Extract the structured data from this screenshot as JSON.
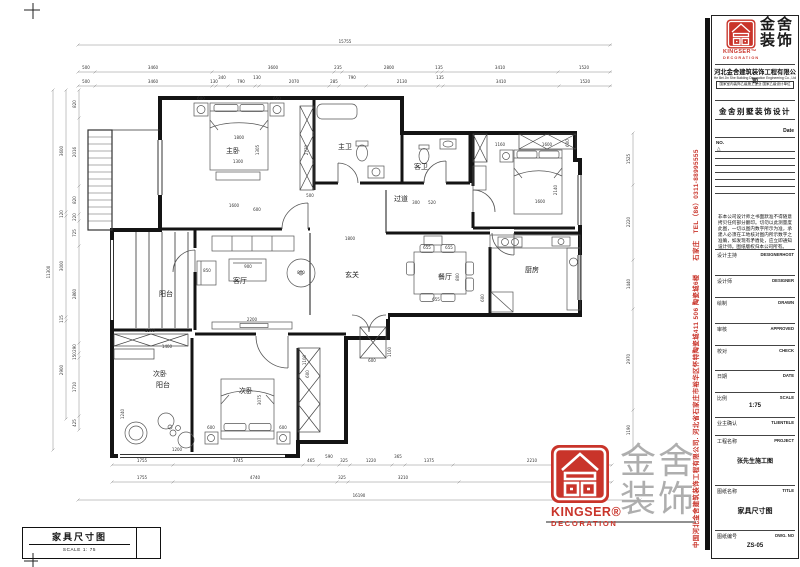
{
  "titleblock": {
    "logo": {
      "en": "KINGSER™",
      "en_sub": "DECORATION",
      "cn_line1": "金舍",
      "cn_line2": "装饰"
    },
    "company_cn": "河北金舍建筑装饰工程有限公司",
    "company_en": "He Bei Jin She Building Decoration Engineering Co., Ltd",
    "credential": "国家室内装饰乙级施工企业 国家乙级设计单位",
    "project_heading": "金舍别墅装饰设计",
    "date_label": "Date",
    "no_label": "NO.",
    "revision_mark": "△",
    "disclaimer": "非本公司设计师之书面默准不得随意拷贝任何部分翻印。切勿以此测量度此图，一切以图内数字所示为准，承建人必须在工地核对图内所示数字之准确，如发现有矛盾处，应立即通知设计师。图纸版权归本公司所有。",
    "fields": [
      {
        "cn": "设计主持",
        "en": "DESIGNERHOST",
        "value": ""
      },
      {
        "cn": "设计师",
        "en": "DESIGNER",
        "value": ""
      },
      {
        "cn": "绘制",
        "en": "DRAWN",
        "value": ""
      },
      {
        "cn": "审核",
        "en": "APPROVED",
        "value": ""
      },
      {
        "cn": "校对",
        "en": "CHECK",
        "value": ""
      },
      {
        "cn": "日期",
        "en": "DATE",
        "value": ""
      },
      {
        "cn": "比例",
        "en": "SCALE",
        "value": "1:75"
      },
      {
        "cn": "业主确认",
        "en": "TLIENTELE",
        "value": ""
      },
      {
        "cn": "工程名称",
        "en": "PROJECT",
        "value": "张先生施工图"
      },
      {
        "cn": "图纸名称",
        "en": "TITLE",
        "value": "家具尺寸图"
      },
      {
        "cn": "图纸编号",
        "en": "DWG. NO",
        "value": "ZS-05"
      }
    ]
  },
  "side_text": "中国河北金舍建筑装饰工程有限公司. 河北省石家庄市裕华区怀特陶瓷城411 506 陶瓷城6楼　　石家庄　TEL（86）0311-88995555",
  "footer": {
    "title": "家具尺寸图",
    "scale": "SCALE 1: 75"
  },
  "watermark": {
    "en": "KINGSER®",
    "en_sub": "DECORATION",
    "cn_line1": "金舍",
    "cn_line2": "装饰"
  },
  "colors": {
    "accent_red": "#c9342a",
    "line_black": "#141414",
    "dim_gray": "#555555"
  },
  "plan": {
    "rooms": {
      "master": "主卧",
      "mbath": "主卫",
      "gbath": "客卫",
      "hall": "过道",
      "foyer": "玄关",
      "living": "客厅",
      "dining": "餐厅",
      "kitchen": "厨房",
      "balcony": "阳台",
      "bal2a": "次卧",
      "bal2b": "阳台",
      "bed2": "次卧"
    },
    "dims": {
      "topall": "15755",
      "top1": [
        "500",
        "3460",
        "3600",
        "235",
        "2800",
        "135",
        "3410",
        "1520"
      ],
      "top2": [
        "500",
        "3460",
        "130",
        "340",
        "790",
        "130",
        "2070",
        "285",
        "790",
        "2130",
        "135",
        "3410",
        "1520"
      ],
      "leftall": "11300",
      "left1": [
        "3600",
        "120",
        "3000",
        "115",
        "2900"
      ],
      "left2": [
        "820",
        "2016",
        "820",
        "220",
        "725",
        "2860",
        "290",
        "150",
        "1710",
        "425"
      ],
      "right1": [
        "1525",
        "2220",
        "1440",
        "2970",
        "1190"
      ],
      "bottomall": "16190",
      "bottom1": [
        "1755",
        "3745",
        "465",
        "590",
        "325",
        "1220",
        "365",
        "1375",
        "2210"
      ],
      "bottom2": [
        "1755",
        "4740",
        "325",
        "3210"
      ],
      "inner": [
        "1800",
        "1305",
        "1300",
        "600",
        "650",
        "2770",
        "500",
        "1600",
        "600",
        "1160",
        "1600",
        "600",
        "2140",
        "1600",
        "300",
        "520",
        "655",
        "655",
        "655",
        "800",
        "600",
        "850",
        "900",
        "800",
        "2200",
        "1800",
        "600",
        "1100",
        "3075",
        "600",
        "600",
        "1100",
        "600",
        "1500",
        "1400",
        "1240",
        "1200"
      ]
    }
  }
}
